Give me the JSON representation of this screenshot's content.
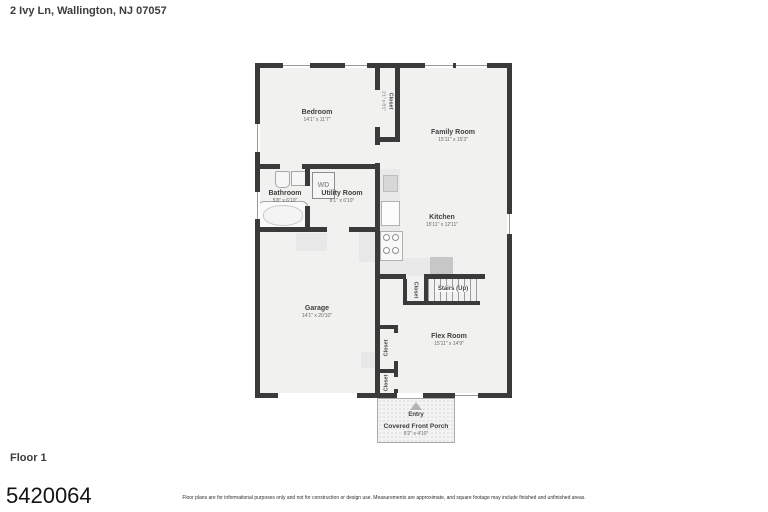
{
  "page": {
    "address": "2 Ivy Ln, Wallington, NJ 07057",
    "floor_label": "Floor 1",
    "listing_id": "5420064",
    "disclaimer": "Floor plans are for informational purposes only and not for construction or design use. Measurements are approximate, and square footage may include finished and unfinished areas."
  },
  "rooms": {
    "bedroom": {
      "name": "Bedroom",
      "dims": "14'1\" x 11'7\""
    },
    "bedroom_closet": {
      "name": "Closet",
      "dims": "2'1\" x 8'1\""
    },
    "family_room": {
      "name": "Family Room",
      "dims": "15'11\" x 15'3\""
    },
    "bathroom": {
      "name": "Bathroom",
      "dims": "5'8\" x 6'10\""
    },
    "utility_room": {
      "name": "Utility Room",
      "dims": "8'1\" x 6'10\""
    },
    "kitchen": {
      "name": "Kitchen",
      "dims": "15'11\" x 12'11\""
    },
    "garage": {
      "name": "Garage",
      "dims": "14'1\" x 20'10\""
    },
    "stairs": {
      "name": "Stairs (Up)"
    },
    "stairs_closet": {
      "name": "Closet"
    },
    "flex_room": {
      "name": "Flex Room",
      "dims": "15'11\" x 14'9\""
    },
    "closet_upper": {
      "name": "Closet"
    },
    "closet_lower": {
      "name": "Closet"
    },
    "entry": {
      "name": "Entry"
    },
    "porch": {
      "name": "Covered Front Porch",
      "dims": "9'2\" x 4'10\""
    }
  },
  "fixtures": {
    "washer_dryer": "WD"
  },
  "colors": {
    "wall": "#3a3a3a",
    "floor": "#f1f1ef",
    "background": "#ffffff"
  }
}
